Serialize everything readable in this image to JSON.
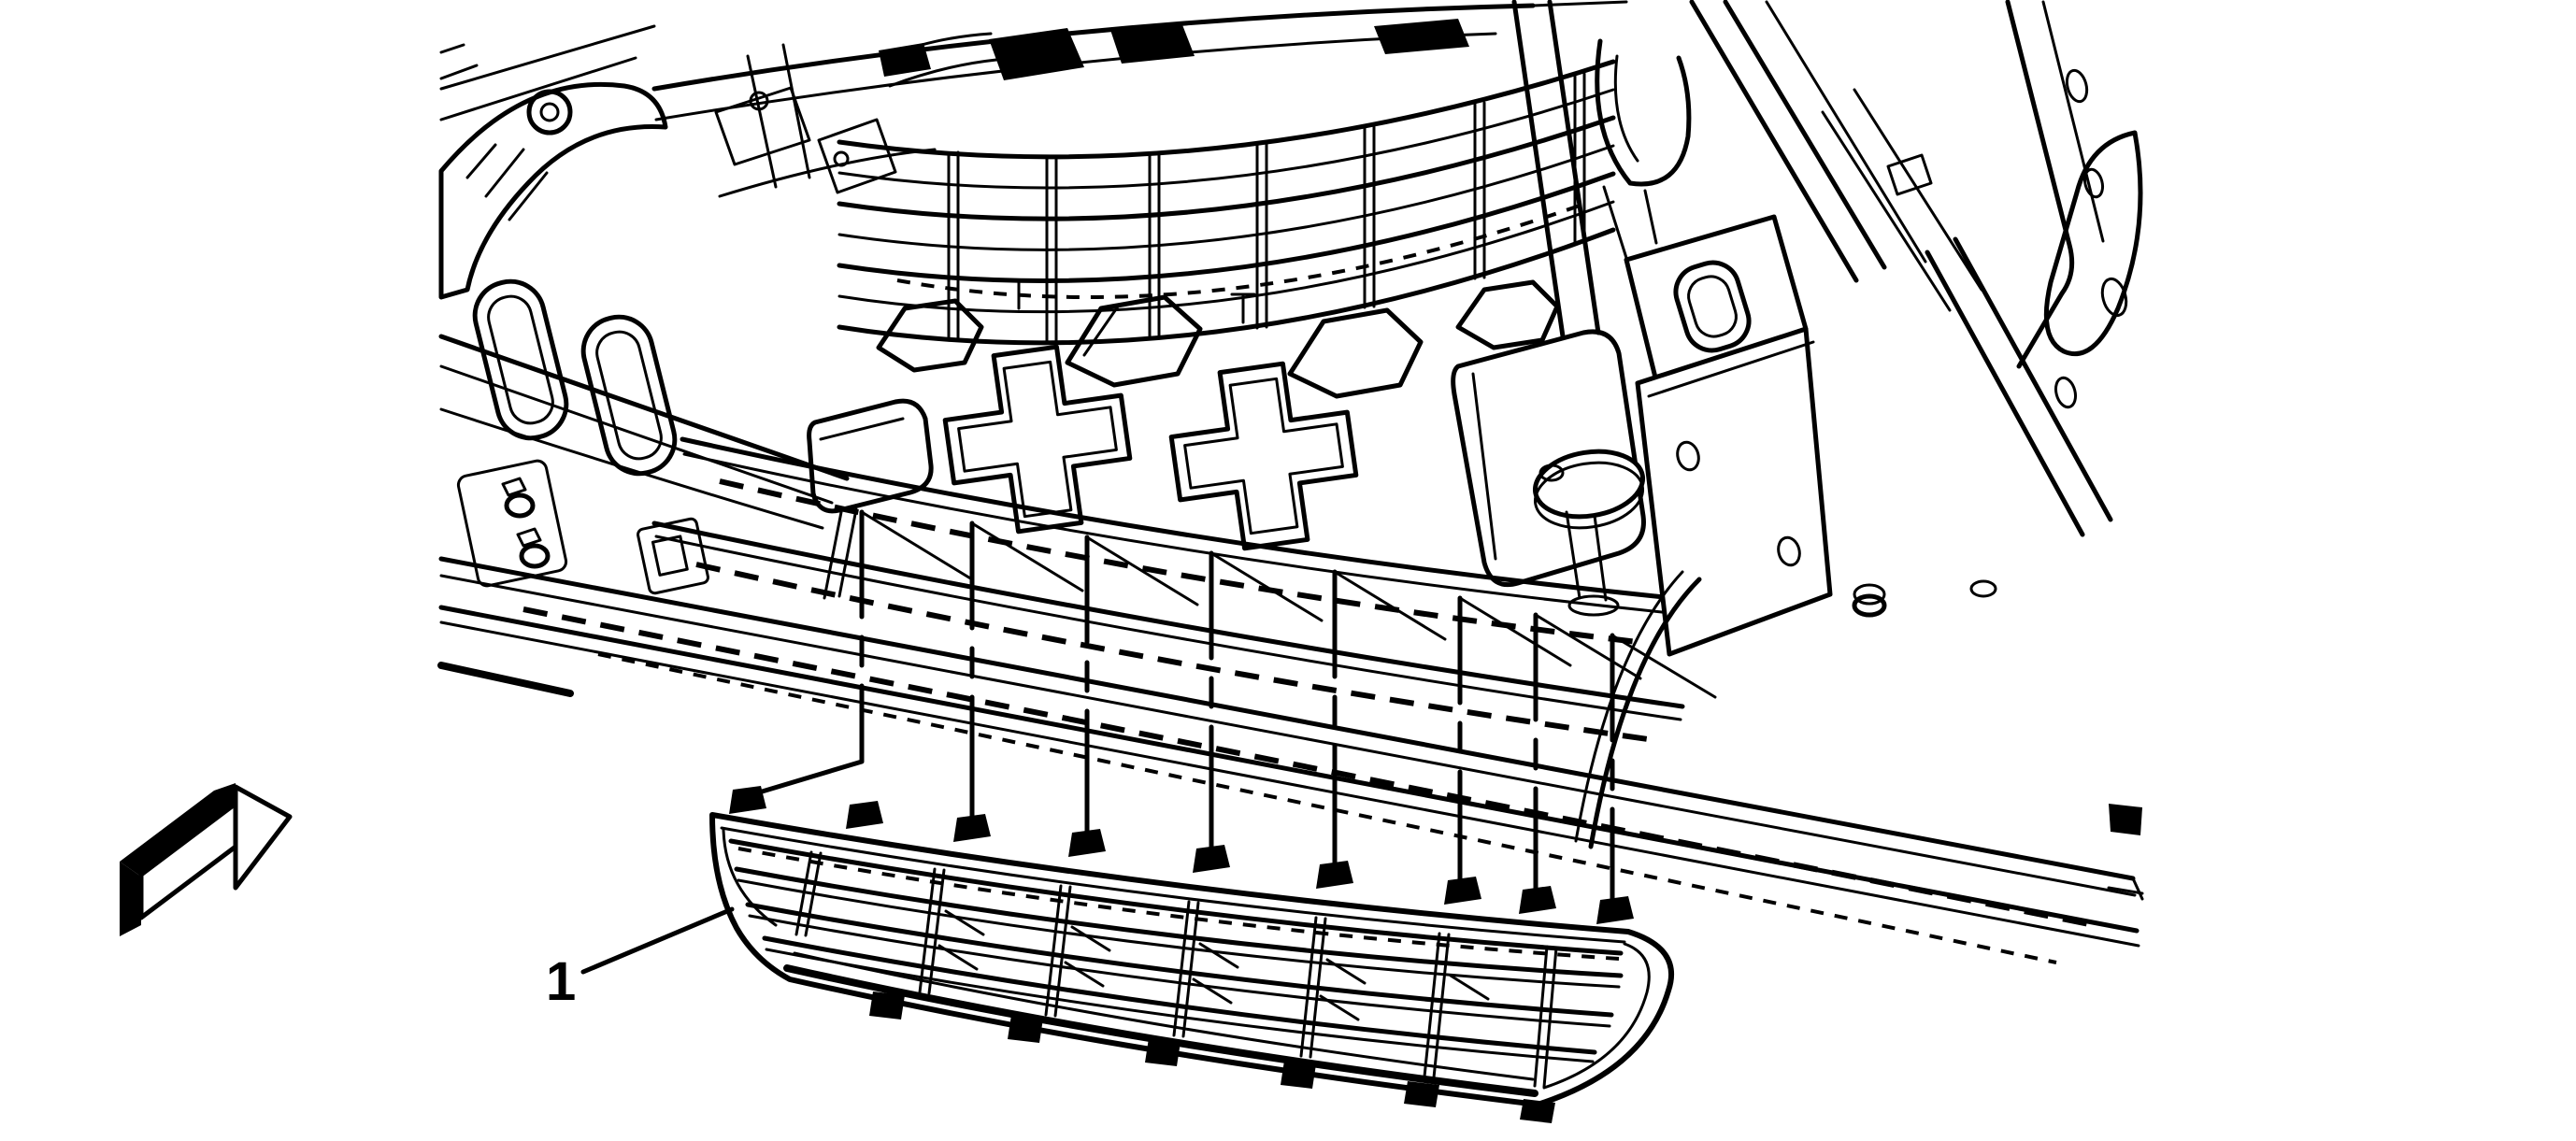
{
  "figure": {
    "kind": "technical-line-illustration",
    "subject": "front bumper lower grille installation",
    "callout": {
      "number": "1"
    },
    "colors": {
      "line": "#000000",
      "background": "#ffffff"
    },
    "icons": [
      {
        "name": "front-of-vehicle-arrow-icon",
        "shape": "3d-block-arrow-pointing-right"
      }
    ],
    "leader_lines": {
      "count": 8,
      "style": "vertical-with-dash-gap-and-top-diagonal"
    }
  }
}
